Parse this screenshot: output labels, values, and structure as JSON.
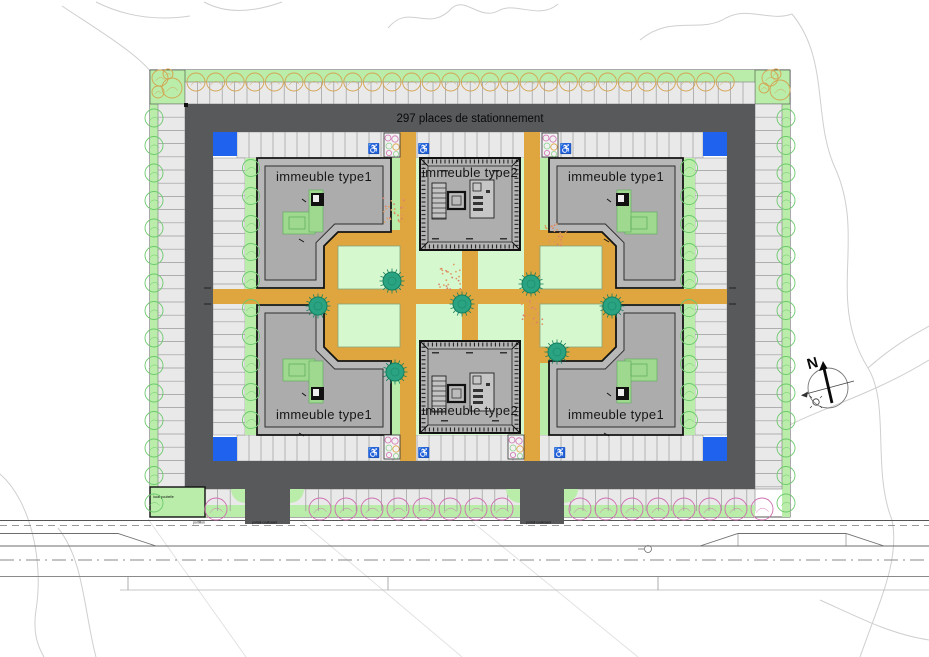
{
  "plan": {
    "title": "297 places de stationnement",
    "buildings": [
      {
        "id": "type1-top-left",
        "label": "immeuble type1"
      },
      {
        "id": "type2-top",
        "label": "immeuble type2"
      },
      {
        "id": "type1-top-right",
        "label": "immeuble type1"
      },
      {
        "id": "type1-bottom-left",
        "label": "immeuble type1"
      },
      {
        "id": "type2-bottom",
        "label": "immeuble type2"
      },
      {
        "id": "type1-bottom-right",
        "label": "immeuble type1"
      }
    ],
    "north_label": "N",
    "small_labels": {
      "waste_room": "local poubelle",
      "gate_pedestrian": "portillon",
      "gate_sliding_left": "portail coulissant",
      "gate_sliding_right": "portail coulissant"
    },
    "icons": {
      "accessible": "♿"
    },
    "colors": {
      "ring_road": "#58595b",
      "parking": "#e9e9e9",
      "stall_line": "#9a9a9a",
      "lawn": "#d6f8cf",
      "green_strip": "#b9eda9",
      "path_ochre": "#dfa53e",
      "tree_teal": "#2aa382",
      "tree_teal_dark": "#14805f",
      "tree_green": "#6cc96c",
      "tree_tan": "#d4a452",
      "tree_pink": "#cf6fb0",
      "accent_blue": "#1f62ed",
      "building_fill": "#b8b8b8",
      "building_inner": "#acacac",
      "shrub": "#e09a5f"
    }
  }
}
